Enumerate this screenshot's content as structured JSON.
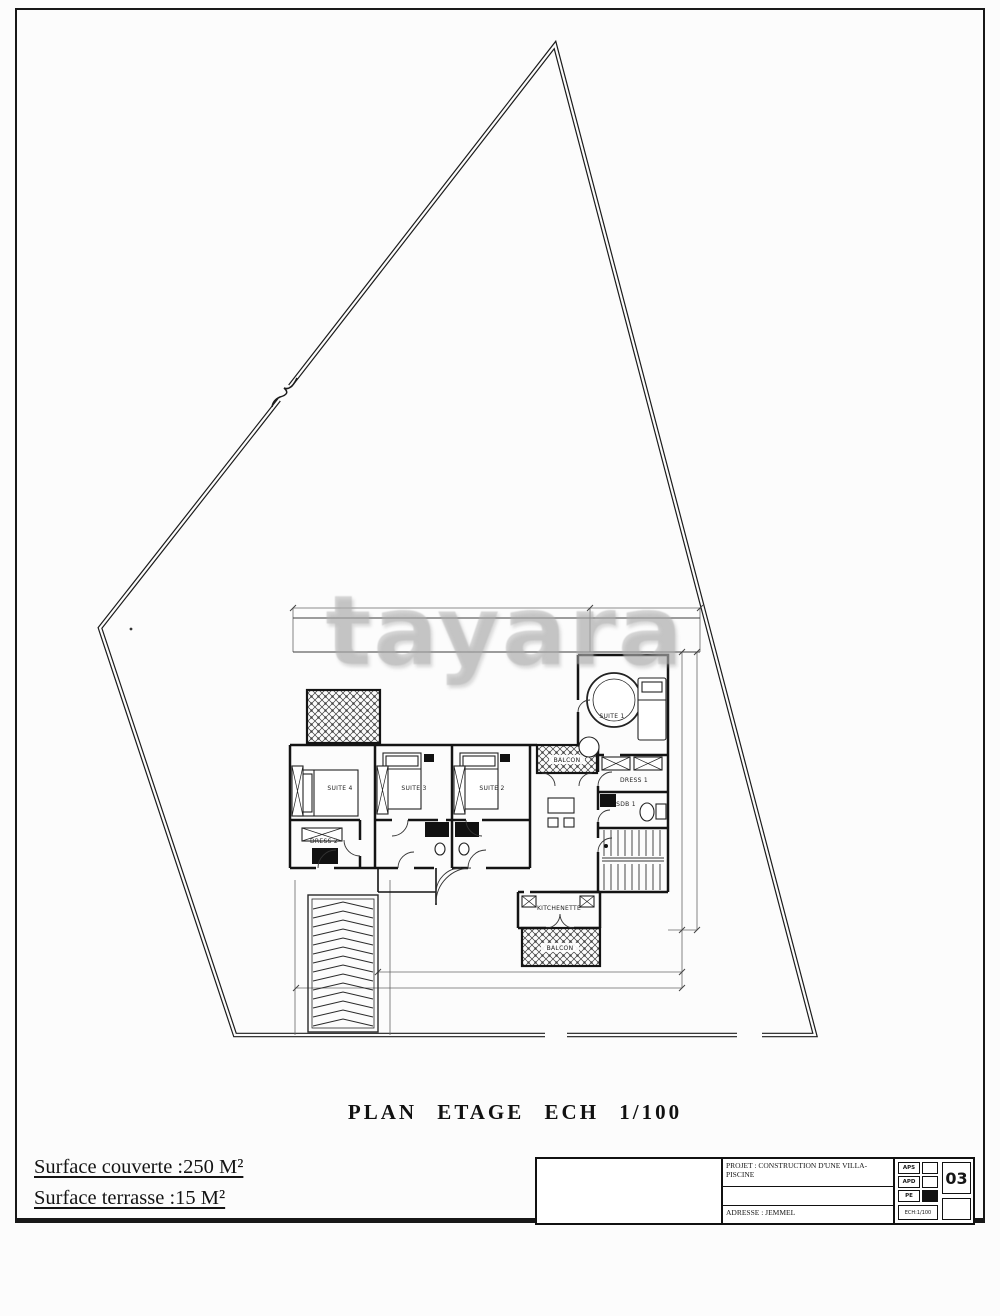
{
  "page": {
    "background": "#fcfcfc",
    "ink": "#161616",
    "watermark": "tayara"
  },
  "footer": {
    "title": "PLAN ETAGE ECH 1/100",
    "surface_couverte": "Surface couverte :250 M²",
    "surface_terrasse": "Surface terrasse :15 M²"
  },
  "title_block": {
    "project": "PROJET :   CONSTRUCTION D'UNE VILLA-PISCINE",
    "address": "ADRESSE :  JEMMEL",
    "phase_rows": [
      "APS",
      "APD",
      "PE"
    ],
    "scale": "ECH:1/100",
    "sheet": "03"
  },
  "plan": {
    "room_labels": [
      "SUITE 1",
      "DRESS 1",
      "SDB 1",
      "SUITE 4",
      "SUITE 3",
      "SUITE 2",
      "BALCON",
      "KITCHENETTE",
      "BALCON",
      "DRESS 2"
    ]
  }
}
